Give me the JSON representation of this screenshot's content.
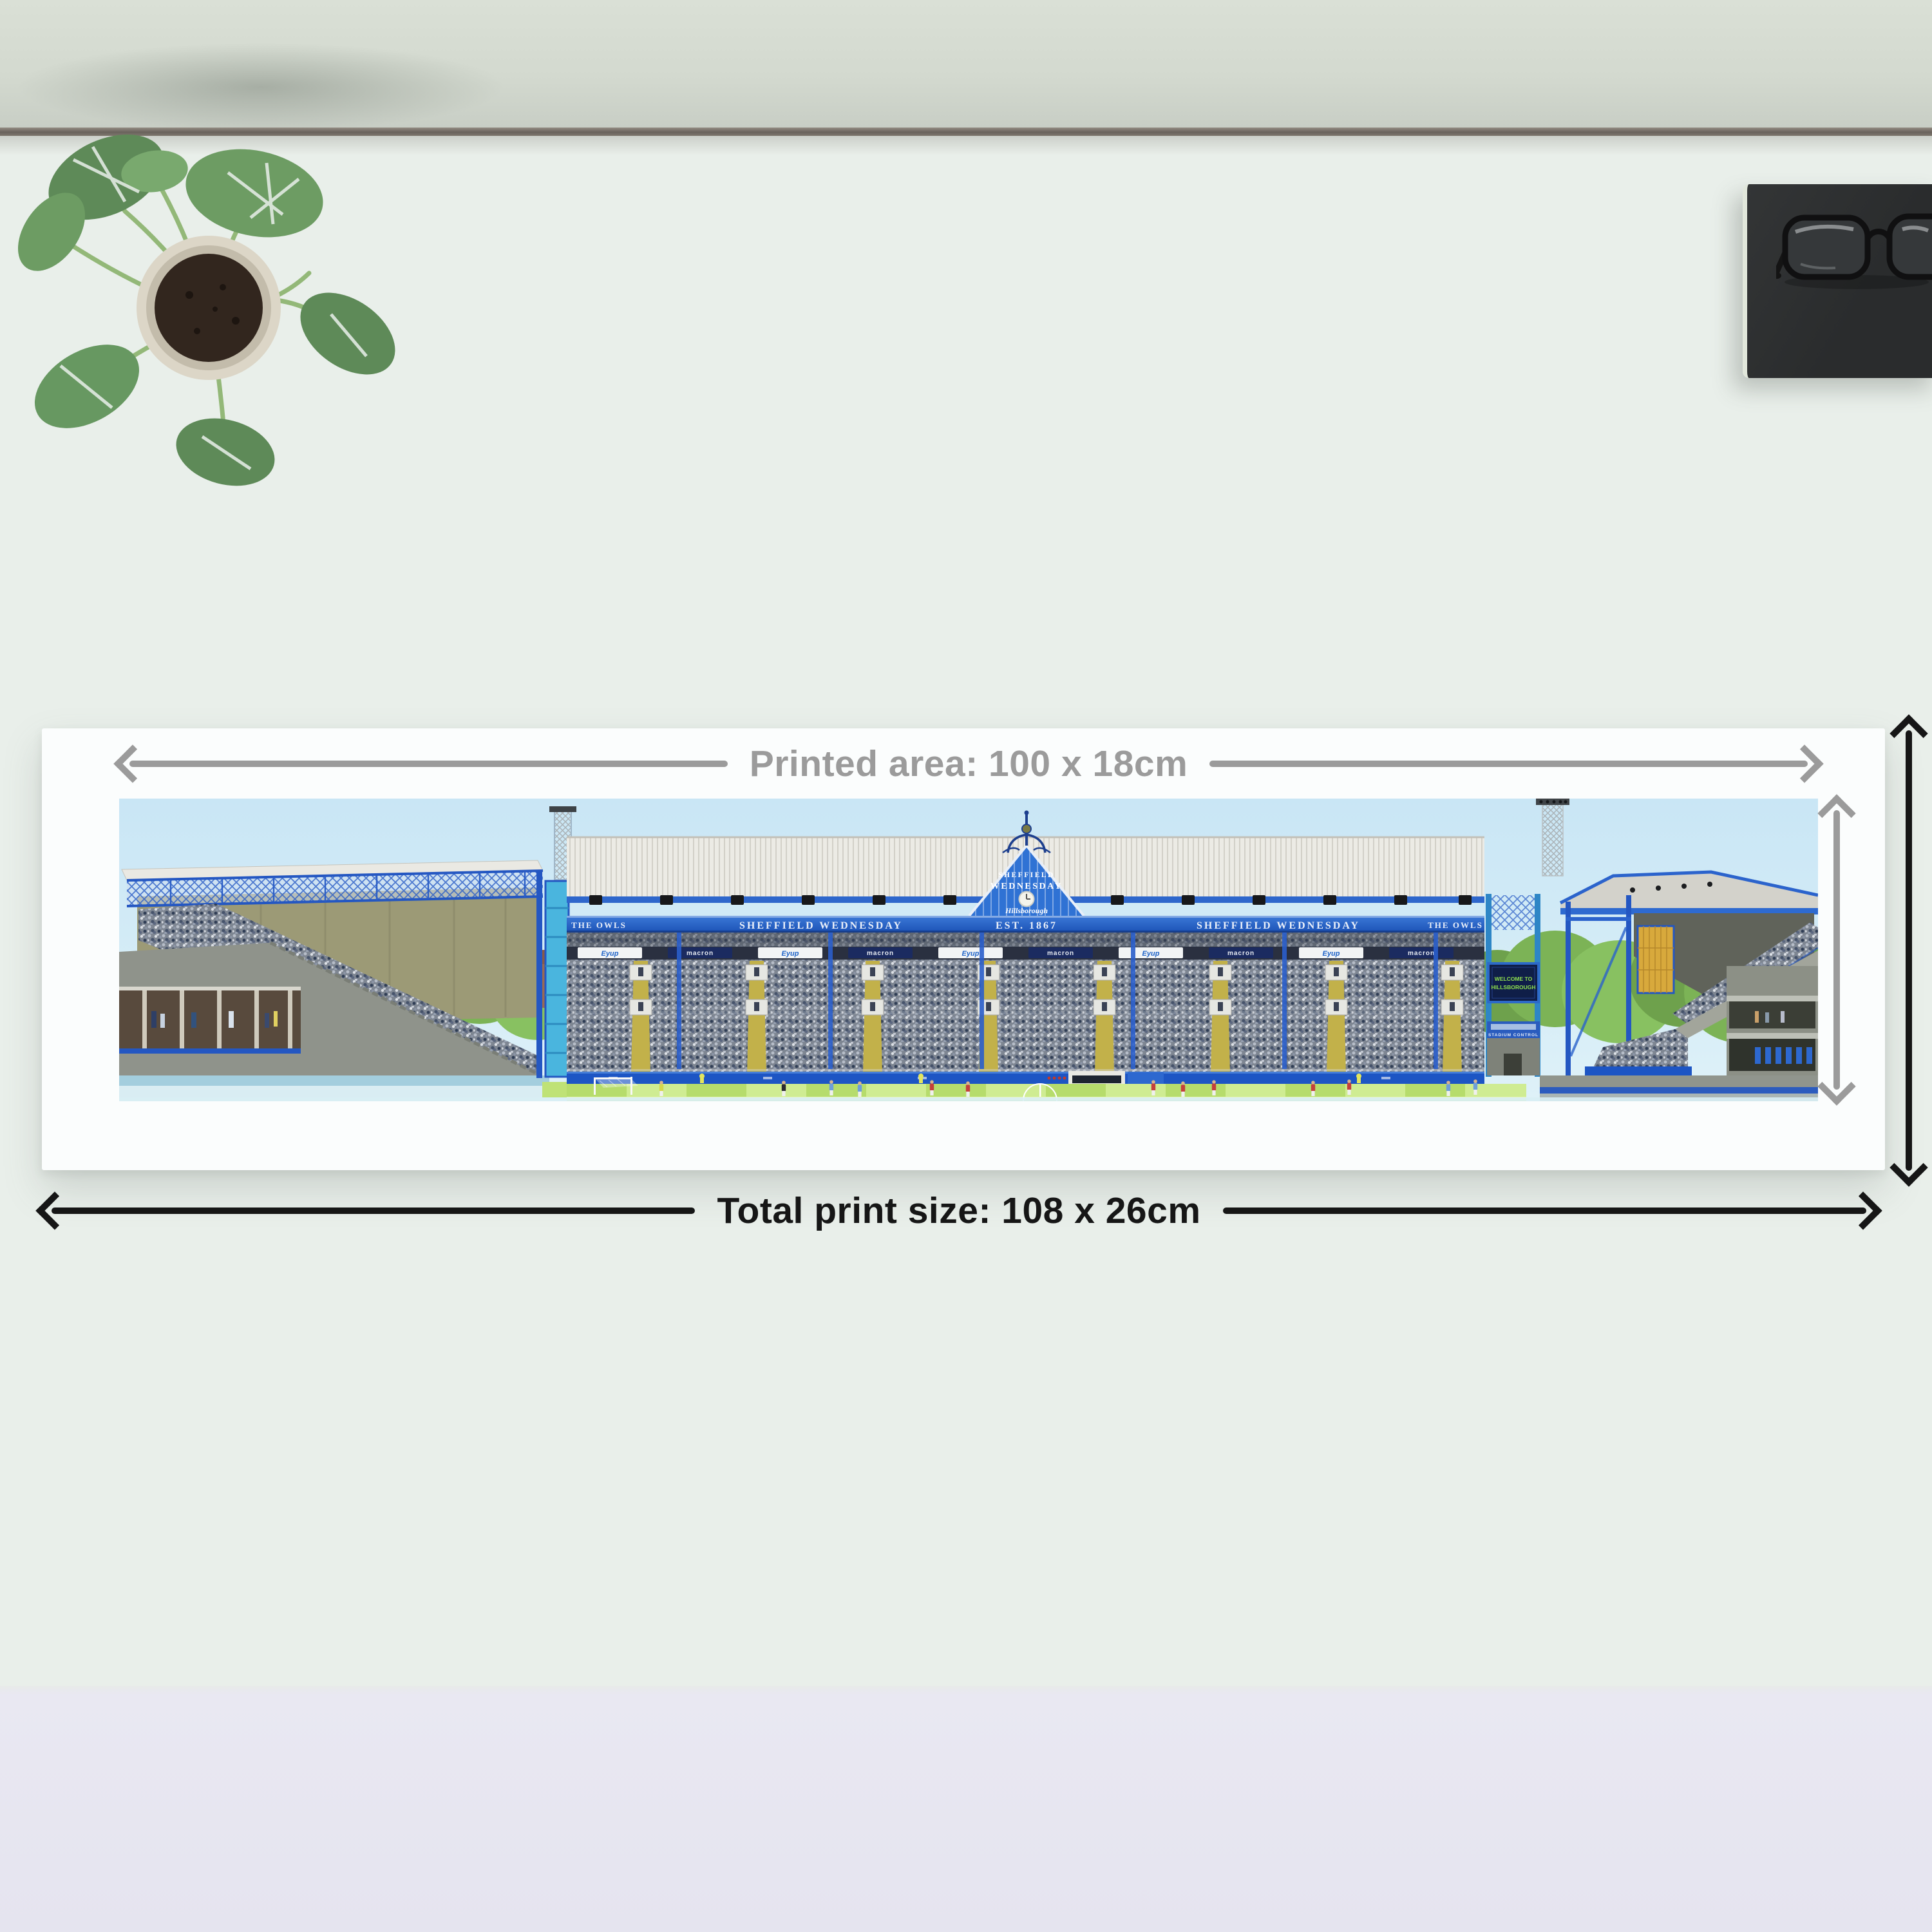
{
  "annotations": {
    "printed_area": "Printed area: 100 x 18cm",
    "total_print": "Total print size: 108 x 26cm"
  },
  "print": {
    "fascia": {
      "owls": "THE OWLS",
      "club": "SHEFFIELD WEDNESDAY",
      "est": "EST. 1867"
    },
    "gable": {
      "line1": "SHEFFIELD",
      "line2": "WEDNESDAY",
      "script": "Hillsborough"
    },
    "screen": {
      "line1": "WELCOME TO",
      "line2": "HILLSBOROUGH"
    },
    "control_room": "STADIUM CONTROL",
    "sponsors": {
      "white_board": "Eyup",
      "dark_board": "macron"
    }
  },
  "colors": {
    "arrow_gray": "#9b9b9b",
    "arrow_black": "#161616",
    "club_blue": "#2457c2",
    "sky_blue": "#cde8f5",
    "pitch_green": "#bfe276",
    "desk": "#e9efea"
  }
}
